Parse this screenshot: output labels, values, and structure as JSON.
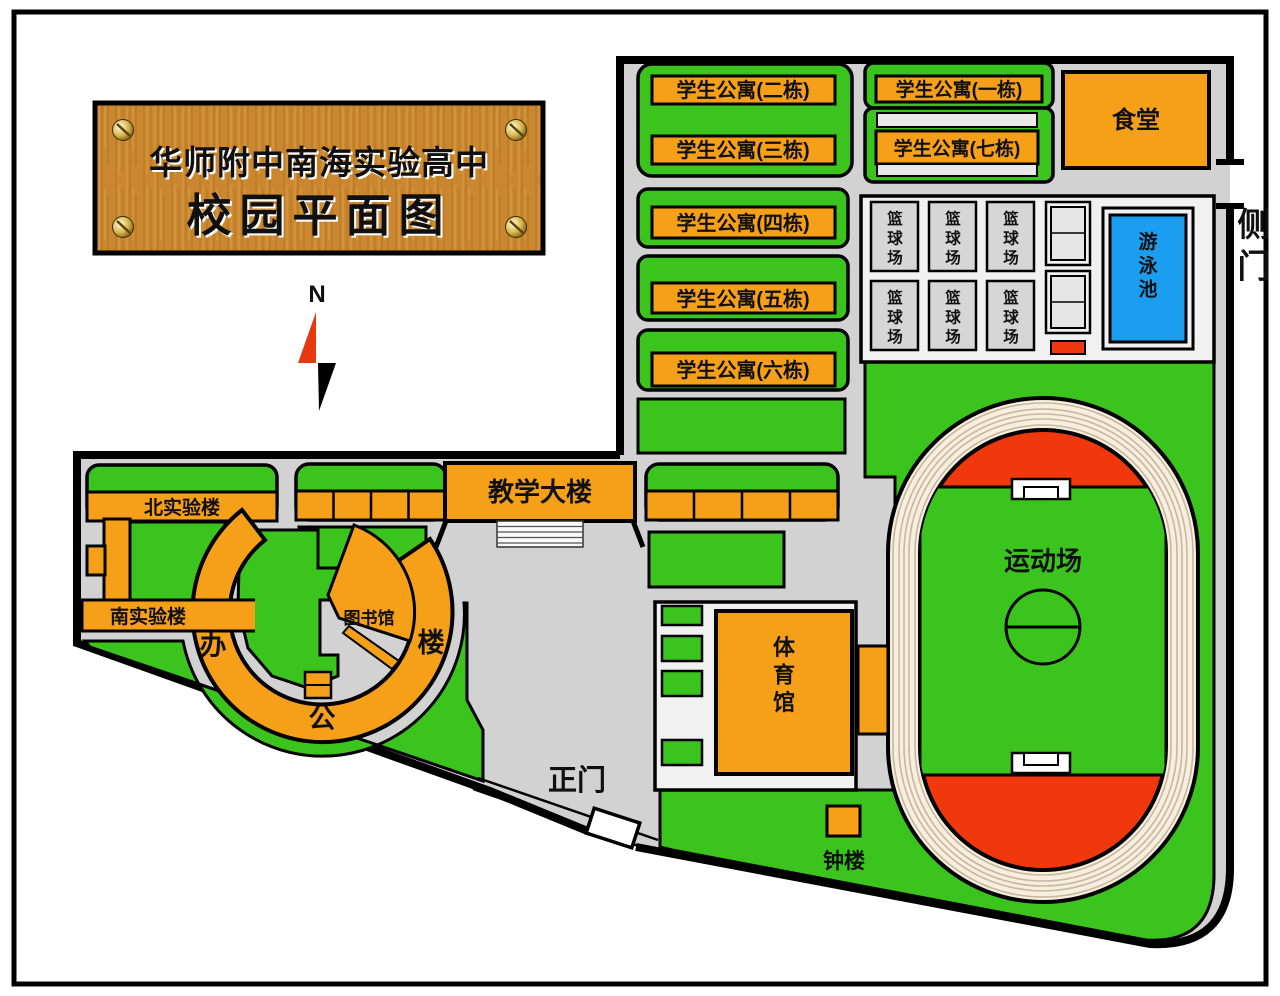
{
  "title_sign": {
    "line1": "华师附中南海实验高中",
    "line2": "校园平面图"
  },
  "compass": {
    "north": "N"
  },
  "dormitories": [
    {
      "id": "building-2",
      "label": "学生公寓(二栋)"
    },
    {
      "id": "building-3",
      "label": "学生公寓(三栋)"
    },
    {
      "id": "building-1",
      "label": "学生公寓(一栋)"
    },
    {
      "id": "building-7",
      "label": "学生公寓(七栋)"
    },
    {
      "id": "building-4",
      "label": "学生公寓(四栋)"
    },
    {
      "id": "building-5",
      "label": "学生公寓(五栋)"
    },
    {
      "id": "building-6",
      "label": "学生公寓(六栋)"
    }
  ],
  "facilities": {
    "canteen": "食堂",
    "swimming_pool": "游泳池",
    "basketball_court": "篮球场",
    "sports_field": "运动场",
    "teaching_building": "教学大楼",
    "north_lab": "北实验楼",
    "south_lab": "南实验楼",
    "library": "图书馆",
    "office_building": "办公楼",
    "gymnasium": "体育馆",
    "clock_tower": "钟楼"
  },
  "gates": {
    "main": "正门",
    "side": "侧门"
  },
  "colors": {
    "green": "#3CC41E",
    "orange": "#F6A01A",
    "red": "#F1380D",
    "blue": "#1B9EF0",
    "campus_gray": "#D2D2D2",
    "track_cream": "#F6EEDE",
    "white_zone": "#F1F1F1",
    "court_gray": "#D6D6D6",
    "wood": "#CA8730"
  }
}
